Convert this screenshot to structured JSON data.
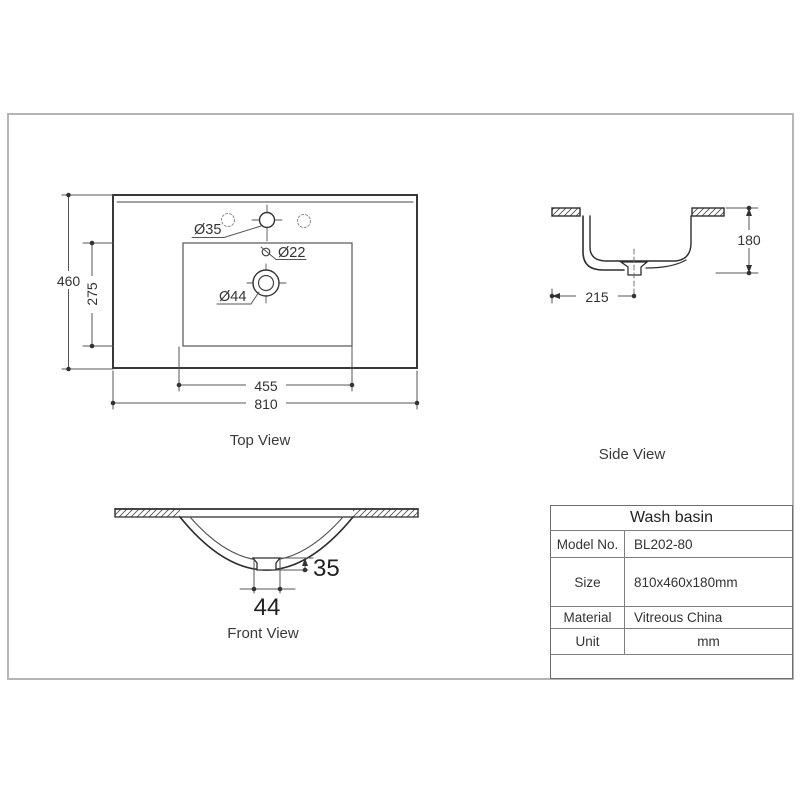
{
  "drawing": {
    "top_view": {
      "label": "Top View",
      "hole_faucet": "Ø35",
      "hole_overflow": "Ø22",
      "hole_drain": "Ø44",
      "dim_outer_width": "810",
      "dim_inner_width": "455",
      "dim_outer_height": "460",
      "dim_inner_height": "275"
    },
    "side_view": {
      "label": "Side View",
      "dim_height": "180",
      "dim_drain_offset": "215"
    },
    "front_view": {
      "label": "Front View",
      "dim_drain_depth": "35",
      "dim_drain_width": "44"
    }
  },
  "spec_table": {
    "title": "Wash basin",
    "rows": [
      {
        "label": "Model No.",
        "value": "BL202-80"
      },
      {
        "label": "Size",
        "value": "810x460x180mm"
      },
      {
        "label": "Material",
        "value": "Vitreous China"
      },
      {
        "label": "Unit",
        "value": "mm"
      }
    ]
  },
  "colors": {
    "line": "#2e2e2e",
    "dim_line": "#555555",
    "frame": "#b5b5b5",
    "table_border": "#6e6e6e"
  }
}
